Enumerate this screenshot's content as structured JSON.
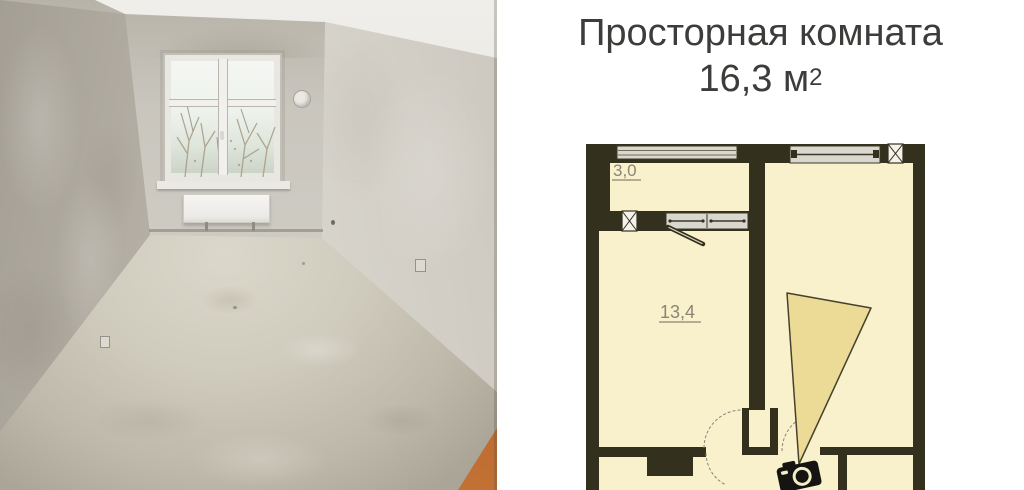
{
  "title": {
    "line1": "Просторная комната",
    "area_value": "16,3 м",
    "area_superscript": "2"
  },
  "floor_plan": {
    "balcony_area_label": "3,0",
    "room_area_label": "13,4",
    "colors": {
      "wall": "#33301e",
      "room_fill": "#f8f1cc",
      "view_cone_fill": "#ecdb96",
      "window_fill": "#d9d7ce",
      "label_text": "#8b8574",
      "camera": "#161410",
      "background": "#ffffff"
    }
  },
  "photo": {
    "colors": {
      "plaster_wall": "#c9c6be",
      "floor_concrete": "#cfcbbd",
      "ceiling": "#eceae6",
      "window_frame": "#f1f0ec",
      "corner_accent_orange": "#b9682f"
    }
  }
}
